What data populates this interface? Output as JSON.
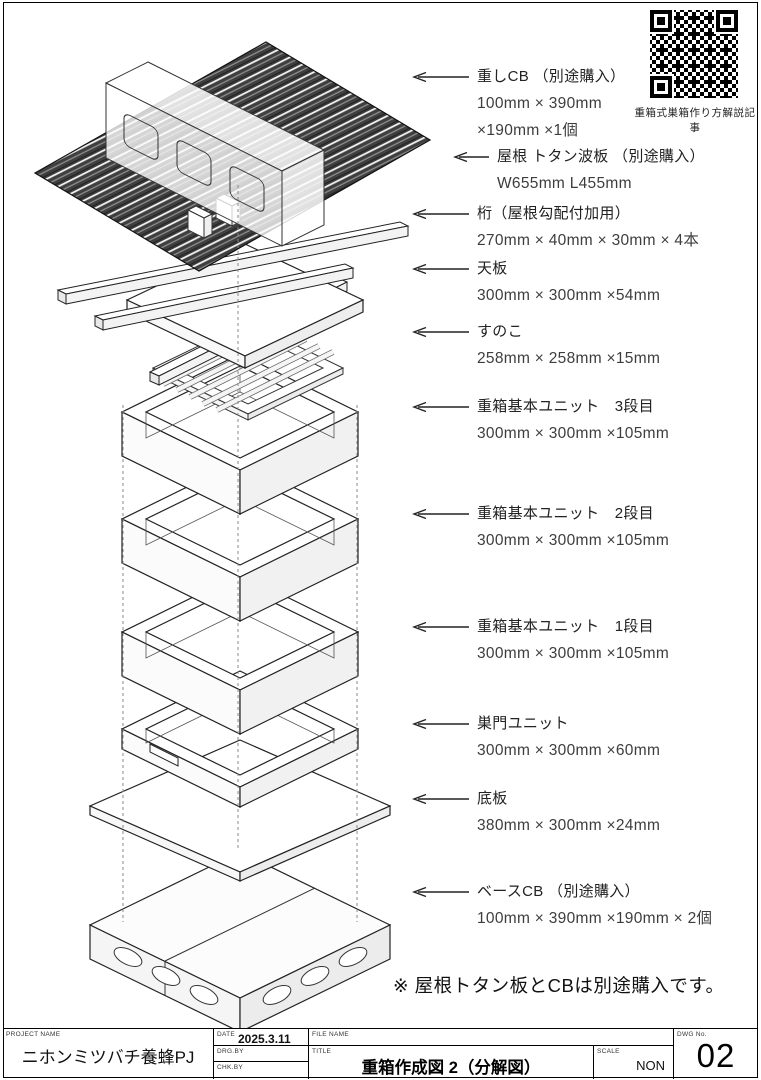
{
  "qr": {
    "caption": "重箱式巣箱作り方解説記事"
  },
  "note": "※ 屋根トタン板とCBは別途購入です。",
  "labels": [
    {
      "name": "重しCB （別途購入）",
      "dims": "100mm × 390mm\n×190mm ×1個"
    },
    {
      "name": "屋根 トタン波板 （別途購入）",
      "dims": "W655mm L455mm"
    },
    {
      "name": "桁（屋根勾配付加用）",
      "dims": "270mm × 40mm × 30mm × 4本"
    },
    {
      "name": "天板",
      "dims": "300mm × 300mm ×54mm"
    },
    {
      "name": "すのこ",
      "dims": "258mm × 258mm ×15mm"
    },
    {
      "name": "重箱基本ユニット　3段目",
      "dims": "300mm × 300mm ×105mm"
    },
    {
      "name": "重箱基本ユニット　2段目",
      "dims": "300mm × 300mm ×105mm"
    },
    {
      "name": "重箱基本ユニット　1段目",
      "dims": "300mm × 300mm ×105mm"
    },
    {
      "name": "巣門ユニット",
      "dims": "300mm × 300mm ×60mm"
    },
    {
      "name": "底板",
      "dims": "380mm × 300mm ×24mm"
    },
    {
      "name": "ベースCB （別途購入）",
      "dims": "100mm × 390mm ×190mm × 2個"
    }
  ],
  "titleblock": {
    "project_label": "PROJECT NAME",
    "project_value": "ニホンミツバチ養蜂PJ",
    "date_label": "DATE",
    "date_value": "2025.3.11",
    "drg_label": "DRG.BY",
    "chk_label": "CHK.BY",
    "file_label": "FILE NAME",
    "title_label": "TITLE",
    "title_value": "重箱作成図 2（分解図）",
    "scale_label": "SCALE",
    "scale_value": "NON",
    "dwg_label": "DWG No.",
    "dwg_value": "02"
  }
}
